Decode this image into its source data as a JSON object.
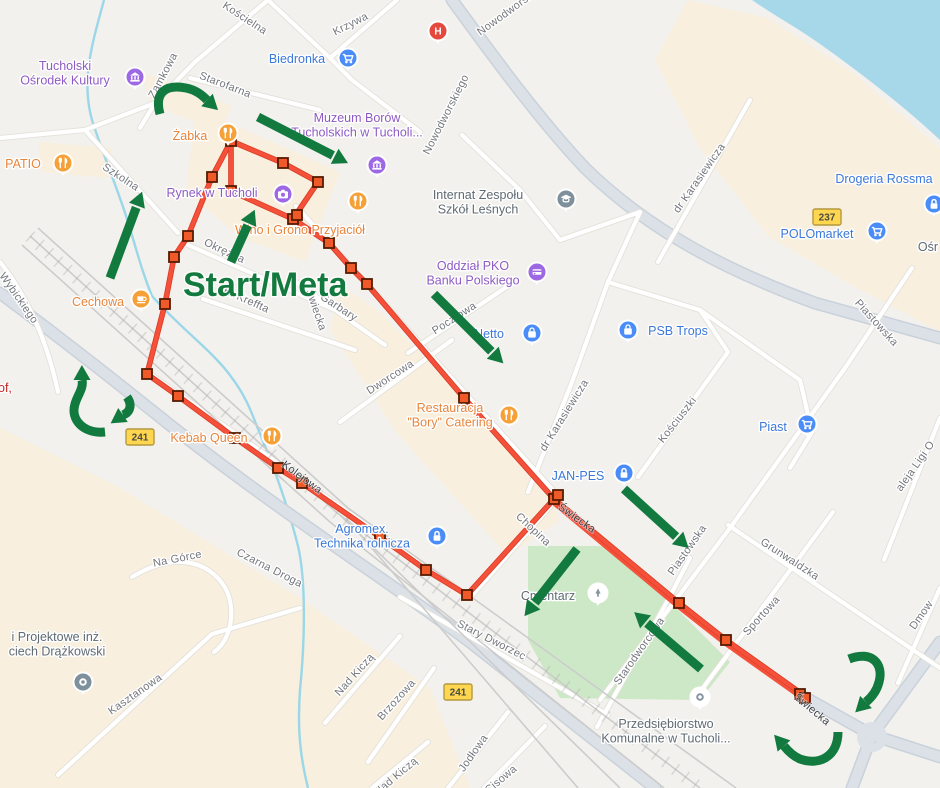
{
  "colors": {
    "land": "#f2f1ed",
    "beige": "#f8efde",
    "green": "#cde8c6",
    "water": "#a6d8ea",
    "stream": "#9bd7e8",
    "road_fill": "#ffffff",
    "road_casing": "#e3e1da",
    "major_road": "#dce1e8",
    "major_casing": "#c9d1da",
    "rail": "#cccccc",
    "route": "#f4503a",
    "route_casing": "#d93a22",
    "square_fill": "#f05a28",
    "square_stroke": "#551b00",
    "arrow_green": "#127a3e",
    "street_label": "#73767c",
    "poi_blue": "#3b78d9",
    "poi_purple": "#8e5bc4",
    "poi_orange": "#e8853d",
    "poi_gray": "#5f6a72",
    "red_fragment": "#c5221f",
    "shield_bg": "#ffd64f",
    "shield_border": "#b3993f",
    "shield_text": "#4a4a44",
    "icon_orange": "#f6a137",
    "icon_blue": "#4b8df8",
    "icon_purple": "#9d68e3",
    "icon_gray": "#7e909b",
    "icon_red": "#e5493d",
    "icon_glyph_gray": "#8795a1"
  },
  "annotations": {
    "start_meta": {
      "text": "Start/Meta",
      "x": 183,
      "y": 296
    }
  },
  "route": {
    "main": [
      [
        231,
        141
      ],
      [
        283,
        163
      ],
      [
        318,
        182
      ],
      [
        293,
        219
      ],
      [
        231,
        191
      ],
      [
        231,
        141
      ],
      [
        212,
        177
      ],
      [
        188,
        236
      ],
      [
        174,
        257
      ],
      [
        165,
        304
      ],
      [
        147,
        374
      ],
      [
        178,
        396
      ],
      [
        235,
        438
      ],
      [
        278,
        468
      ],
      [
        302,
        483
      ],
      [
        380,
        537
      ],
      [
        426,
        570
      ],
      [
        467,
        595
      ],
      [
        554,
        499
      ],
      [
        464,
        398
      ],
      [
        367,
        284
      ],
      [
        351,
        268
      ],
      [
        329,
        243
      ],
      [
        293,
        219
      ]
    ],
    "outback_a": [
      [
        554,
        499
      ],
      [
        679,
        603
      ],
      [
        726,
        640
      ],
      [
        802,
        694
      ]
    ],
    "outback_b": [
      [
        551.5,
        502.2
      ],
      [
        676.5,
        606.2
      ],
      [
        723.5,
        643.2
      ],
      [
        799.5,
        697.2
      ]
    ],
    "squares": [
      [
        231,
        141
      ],
      [
        283,
        163
      ],
      [
        318,
        182
      ],
      [
        212,
        177
      ],
      [
        231,
        191
      ],
      [
        293,
        219
      ],
      [
        297,
        215
      ],
      [
        188,
        236
      ],
      [
        329,
        243
      ],
      [
        174,
        257
      ],
      [
        351,
        268
      ],
      [
        367,
        284
      ],
      [
        165,
        304
      ],
      [
        147,
        374
      ],
      [
        178,
        396
      ],
      [
        235,
        438
      ],
      [
        278,
        468
      ],
      [
        302,
        483
      ],
      [
        380,
        537
      ],
      [
        426,
        570
      ],
      [
        467,
        595
      ],
      [
        464,
        398
      ],
      [
        554,
        499
      ],
      [
        558,
        495
      ],
      [
        679,
        603
      ],
      [
        726,
        640
      ],
      [
        800,
        694
      ],
      [
        805,
        698
      ]
    ]
  },
  "arrows": [
    {
      "type": "straight",
      "from": [
        258,
        117
      ],
      "to": [
        340,
        159
      ]
    },
    {
      "type": "straight",
      "from": [
        110,
        278
      ],
      "to": [
        139,
        200
      ]
    },
    {
      "type": "straight",
      "from": [
        231,
        262
      ],
      "to": [
        251,
        218
      ]
    },
    {
      "type": "straight",
      "from": [
        434,
        294
      ],
      "to": [
        497,
        357
      ]
    },
    {
      "type": "straight",
      "from": [
        577,
        549
      ],
      "to": [
        530,
        609
      ]
    },
    {
      "type": "straight",
      "from": [
        624,
        489
      ],
      "to": [
        682,
        542
      ]
    },
    {
      "type": "straight",
      "from": [
        701,
        669
      ],
      "to": [
        641,
        618
      ]
    },
    {
      "type": "curved",
      "d": "M 160,114 C 154,92 166,84 186,88 C 196,90 202,95 207,100"
    },
    {
      "type": "curved",
      "d": "M 105,432 C 84,434 70,420 75,404 C 77,396 84,388 82,380"
    },
    {
      "type": "curved",
      "d": "M 127,397 C 132,404 131,412 123,415"
    },
    {
      "type": "curved",
      "d": "M 849,659 C 872,650 884,664 879,682 C 877,690 872,697 866,702"
    },
    {
      "type": "curved",
      "d": "M 838,732 C 838,756 820,766 800,759 C 793,756 788,751 784,746"
    }
  ],
  "shields": [
    {
      "text": "237",
      "x": 827,
      "y": 217
    },
    {
      "text": "241",
      "x": 140,
      "y": 437
    },
    {
      "text": "241",
      "x": 458,
      "y": 692
    }
  ],
  "streets": [
    {
      "text": "Kościelna",
      "x": 243,
      "y": 21,
      "rot": 33
    },
    {
      "text": "Krzywa",
      "x": 352,
      "y": 27,
      "rot": -27
    },
    {
      "text": "Nowodworskiego",
      "x": 449,
      "y": 116,
      "rot": -63
    },
    {
      "text": "Nowodworskiego",
      "x": 516,
      "y": 10,
      "rot": -36
    },
    {
      "text": "Zamkowa",
      "x": 166,
      "y": 77,
      "rot": -62
    },
    {
      "text": "Starofarna",
      "x": 224,
      "y": 88,
      "rot": 21
    },
    {
      "text": "Szkolna",
      "x": 119,
      "y": 180,
      "rot": 33
    },
    {
      "text": "Okrężna",
      "x": 223,
      "y": 254,
      "rot": 25
    },
    {
      "text": "K. Kreffta",
      "x": 245,
      "y": 303,
      "rot": 24
    },
    {
      "text": "Garbary",
      "x": 337,
      "y": 310,
      "rot": 33
    },
    {
      "text": "Świecka",
      "x": 313,
      "y": 311,
      "rot": 71
    },
    {
      "text": "Pocztowa",
      "x": 456,
      "y": 321,
      "rot": -33
    },
    {
      "text": "Dworcowa",
      "x": 392,
      "y": 380,
      "rot": -33
    },
    {
      "text": "dr Karasiewicza",
      "x": 702,
      "y": 180,
      "rot": -55
    },
    {
      "text": "dr Karasiewicza",
      "x": 567,
      "y": 417,
      "rot": -58
    },
    {
      "text": "Kościuszki",
      "x": 680,
      "y": 422,
      "rot": -52
    },
    {
      "text": "Piastowska",
      "x": 874,
      "y": 325,
      "rot": 48
    },
    {
      "text": "Piastowska",
      "x": 690,
      "y": 552,
      "rot": -55
    },
    {
      "text": "Grunwaldzka",
      "x": 788,
      "y": 562,
      "rot": 33
    },
    {
      "text": "Sportowa",
      "x": 764,
      "y": 618,
      "rot": -48
    },
    {
      "text": "Starodworcowa",
      "x": 642,
      "y": 653,
      "rot": -55
    },
    {
      "text": "Chopina",
      "x": 531,
      "y": 532,
      "rot": 43
    },
    {
      "text": "Świecka",
      "x": 575,
      "y": 521,
      "rot": 35,
      "variant": "onroute"
    },
    {
      "text": "Świecka",
      "x": 810,
      "y": 712,
      "rot": 40,
      "variant": "onroute"
    },
    {
      "text": "Kolejowa",
      "x": 300,
      "y": 480,
      "rot": 37,
      "variant": "onroute"
    },
    {
      "text": "Stary Dworzec",
      "x": 490,
      "y": 643,
      "rot": 27
    },
    {
      "text": "Czarna Droga",
      "x": 268,
      "y": 571,
      "rot": 27
    },
    {
      "text": "Na Górce",
      "x": 178,
      "y": 562,
      "rot": -11
    },
    {
      "text": "Kasztanowa",
      "x": 137,
      "y": 697,
      "rot": -35
    },
    {
      "text": "Nad Kiczą",
      "x": 357,
      "y": 677,
      "rot": -48
    },
    {
      "text": "Nad Kiczą",
      "x": 398,
      "y": 779,
      "rot": -40
    },
    {
      "text": "Brzozowa",
      "x": 399,
      "y": 702,
      "rot": -48
    },
    {
      "text": "Jodłowa",
      "x": 476,
      "y": 755,
      "rot": -55
    },
    {
      "text": "Cisowa",
      "x": 503,
      "y": 782,
      "rot": -40
    },
    {
      "text": "Wybickiego",
      "x": 16,
      "y": 300,
      "rot": 55
    },
    {
      "text": "aleja Ligi O",
      "x": 918,
      "y": 468,
      "rot": -55
    },
    {
      "text": "Dmow",
      "x": 924,
      "y": 617,
      "rot": -55
    }
  ],
  "pois": [
    {
      "name": "tucholski-osrodek-kultury",
      "lines": [
        "Tucholski",
        "Ośrodek Kultury"
      ],
      "tx": 65,
      "ty": 70,
      "color": "purple",
      "icon": "museum",
      "ibg": "purple",
      "ix": 135,
      "iy": 77
    },
    {
      "name": "patio",
      "lines": [
        "PATIO"
      ],
      "tx": 23,
      "ty": 168,
      "color": "orange",
      "icon": "restaurant",
      "ibg": "orange",
      "ix": 63,
      "iy": 163
    },
    {
      "name": "zabka",
      "lines": [
        "Żabka"
      ],
      "tx": 190,
      "ty": 140,
      "color": "orange",
      "icon": "restaurant",
      "ibg": "orange",
      "ix": 228,
      "iy": 133
    },
    {
      "name": "rynek-w-tucholi",
      "lines": [
        "Rynek w Tucholi"
      ],
      "tx": 212,
      "ty": 197,
      "color": "purple",
      "icon": "camera",
      "ibg": "purple",
      "ix": 283,
      "iy": 194
    },
    {
      "name": "muzeum-borow",
      "lines": [
        "Muzeum Borów",
        "Tucholskich w Tucholi..."
      ],
      "tx": 357,
      "ty": 122,
      "color": "purple",
      "icon": "museum",
      "ibg": "purple",
      "ix": 377,
      "iy": 165
    },
    {
      "name": "wino-i-grono",
      "lines": [
        "Wino i Grono Przyjaciół"
      ],
      "tx": 300,
      "ty": 234,
      "color": "orange",
      "icon": "restaurant",
      "ibg": "orange",
      "ix": 358,
      "iy": 201
    },
    {
      "name": "biedronka",
      "lines": [
        "Biedronka"
      ],
      "tx": 297,
      "ty": 63,
      "color": "blue",
      "icon": "cart",
      "ibg": "blue",
      "ix": 348,
      "iy": 58
    },
    {
      "name": "hospital",
      "lines": [],
      "tx": 0,
      "ty": 0,
      "color": "gray",
      "icon": "hospital",
      "ibg": "red",
      "ix": 438,
      "iy": 31
    },
    {
      "name": "internat-zespolu-szkol-lesnych",
      "lines": [
        "Internat Zespołu",
        "Szkół Leśnych"
      ],
      "tx": 478,
      "ty": 199,
      "color": "gray",
      "icon": "school",
      "ibg": "gray",
      "ix": 566,
      "iy": 199
    },
    {
      "name": "oddzial-pko",
      "lines": [
        "Oddział PKO",
        "Banku Polskiego"
      ],
      "tx": 473,
      "ty": 270,
      "color": "purple",
      "icon": "bank",
      "ibg": "purple",
      "ix": 537,
      "iy": 272
    },
    {
      "name": "netto",
      "lines": [
        "Netto"
      ],
      "tx": 489,
      "ty": 338,
      "color": "blue",
      "icon": "bag",
      "ibg": "blue",
      "ix": 532,
      "iy": 333
    },
    {
      "name": "psb-trops",
      "lines": [
        "PSB Trops"
      ],
      "tx": 678,
      "ty": 335,
      "color": "blue",
      "icon": "bag",
      "ibg": "blue",
      "ix": 628,
      "iy": 330
    },
    {
      "name": "drogeria-rossmann",
      "lines": [
        "Drogeria Rossma"
      ],
      "tx": 884,
      "ty": 183,
      "color": "blue",
      "icon": "none",
      "ibg": "blue",
      "ix": 0,
      "iy": 0
    },
    {
      "name": "shop-lock-right-edge",
      "lines": [],
      "tx": 0,
      "ty": 0,
      "color": "blue",
      "icon": "lock",
      "ibg": "blue",
      "ix": 934,
      "iy": 204
    },
    {
      "name": "polomarket",
      "lines": [
        "POLOmarket"
      ],
      "tx": 817,
      "ty": 238,
      "color": "blue",
      "icon": "cart",
      "ibg": "blue",
      "ix": 877,
      "iy": 231
    },
    {
      "name": "piast",
      "lines": [
        "Piast"
      ],
      "tx": 773,
      "ty": 431,
      "color": "blue",
      "icon": "cart",
      "ibg": "blue",
      "ix": 807,
      "iy": 424
    },
    {
      "name": "restauracja-bory",
      "lines": [
        "Restauracja",
        "\"Bory\" Catering"
      ],
      "tx": 450,
      "ty": 412,
      "color": "orange",
      "icon": "restaurant",
      "ibg": "orange",
      "ix": 509,
      "iy": 415
    },
    {
      "name": "jan-pes",
      "lines": [
        "JAN-PES"
      ],
      "tx": 578,
      "ty": 480,
      "color": "blue",
      "icon": "lock",
      "ibg": "blue",
      "ix": 624,
      "iy": 473
    },
    {
      "name": "cechowa",
      "lines": [
        "Cechowa"
      ],
      "tx": 98,
      "ty": 306,
      "color": "orange",
      "icon": "coffee",
      "ibg": "orange",
      "ix": 141,
      "iy": 299
    },
    {
      "name": "kebab-queen",
      "lines": [
        "Kebab Queen"
      ],
      "tx": 209,
      "ty": 442,
      "color": "orange",
      "icon": "restaurant",
      "ibg": "orange",
      "ix": 272,
      "iy": 436
    },
    {
      "name": "agromex",
      "lines": [
        "Agromex.",
        "Technika rolnicza"
      ],
      "tx": 362,
      "ty": 533,
      "color": "blue",
      "icon": "lock",
      "ibg": "blue",
      "ix": 437,
      "iy": 536
    },
    {
      "name": "cmentarz",
      "lines": [
        "Cmentarz"
      ],
      "tx": 548,
      "ty": 600,
      "color": "gray",
      "icon": "cemetery",
      "ibg": "light",
      "ix": 598,
      "iy": 593
    },
    {
      "name": "przedsiebiorstwo-komunalne",
      "lines": [
        "Przedsiębiorstwo",
        "Komunalne w Tucholi..."
      ],
      "tx": 666,
      "ty": 728,
      "color": "gray",
      "icon": "dotpin-light",
      "ibg": "light",
      "ix": 700,
      "iy": 697
    },
    {
      "name": "drazkowski",
      "lines": [
        "i Projektowe inż.",
        "ciech Drążkowski"
      ],
      "tx": 57,
      "ty": 641,
      "color": "gray",
      "icon": "dotpin-dark",
      "ibg": "gray",
      "ix": 83,
      "iy": 682
    },
    {
      "name": "osr-fragment",
      "lines": [
        "Ośr"
      ],
      "tx": 928,
      "ty": 251,
      "color": "gray",
      "icon": "none",
      "ibg": "gray",
      "ix": 0,
      "iy": 0
    }
  ],
  "fragments": [
    {
      "text": "of,",
      "x": -2,
      "y": 392,
      "color": "red"
    }
  ]
}
